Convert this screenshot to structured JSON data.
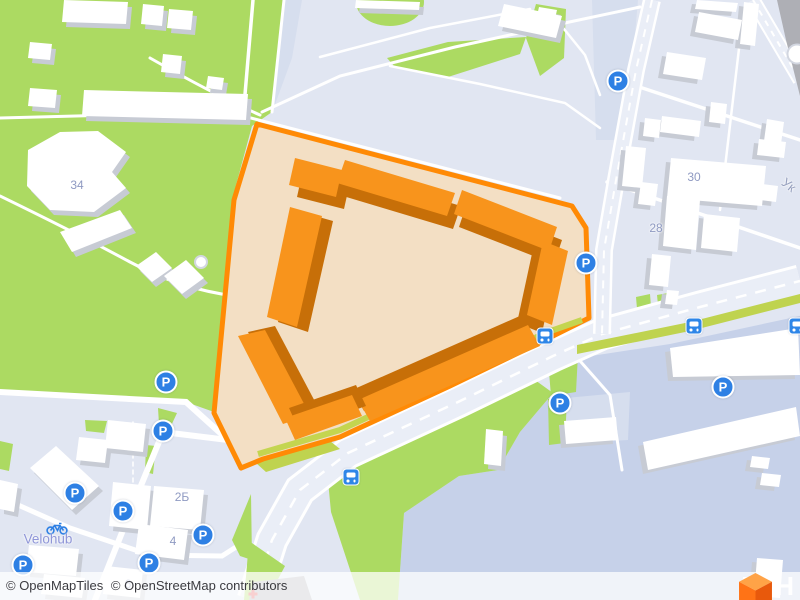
{
  "map": {
    "attribution": {
      "openmaptiles": "© OpenMapTiles",
      "osm": "© OpenStreetMap contributors"
    },
    "logo": {
      "text": "ЛУН"
    },
    "labels": {
      "buildings": [
        {
          "text": "34",
          "x": 77,
          "y": 185
        },
        {
          "text": "30",
          "x": 694,
          "y": 177
        },
        {
          "text": "28",
          "x": 656,
          "y": 228
        },
        {
          "text": "2Б",
          "x": 182,
          "y": 497
        },
        {
          "text": "4",
          "x": 173,
          "y": 541
        },
        {
          "text": "6",
          "x": 128,
          "y": 584
        }
      ],
      "streets": [
        {
          "text": "Ук",
          "x": 789,
          "y": 185,
          "rotation": 38
        }
      ],
      "pois": [
        {
          "text": "Velohub",
          "x": 48,
          "y": 539
        }
      ]
    },
    "icons": {
      "parking": {
        "glyph": "P",
        "color": "#2E80E4",
        "positions": [
          [
            163,
            431
          ],
          [
            75,
            493
          ],
          [
            123,
            511
          ],
          [
            203,
            535
          ],
          [
            23,
            565
          ],
          [
            149,
            563
          ],
          [
            166,
            382
          ],
          [
            618,
            81
          ],
          [
            586,
            263
          ],
          [
            723,
            387
          ],
          [
            560,
            403
          ]
        ]
      },
      "bus": {
        "color": "#2E86E8",
        "positions": [
          [
            545,
            336
          ],
          [
            694,
            326
          ],
          [
            351,
            477
          ],
          [
            797,
            326
          ]
        ]
      },
      "bicycle": {
        "color": "#2E80E4",
        "position": [
          46,
          521
        ]
      },
      "poi_circles": [
        {
          "x": 797,
          "y": 54,
          "d": 17
        },
        {
          "x": 201,
          "y": 262,
          "d": 10
        }
      ],
      "medical_cross": {
        "color": "#E54B4B",
        "position": [
          253,
          594
        ]
      }
    },
    "colors": {
      "land": "#E1E6F2",
      "water": "#C6D1E9",
      "park_green": "#ACDA62",
      "roadside_green": "#BFD34F",
      "road_fill": "#EAEEF7",
      "road_casing": "#FFFFFF",
      "plaza": "#D6DEEE",
      "building_fill": "#FFFFFF",
      "building_shadow": "#C7CBD4",
      "gray_strip": "#AEAFB5",
      "highlight_outline": "#FF8A05",
      "highlight_fill": "#F3DFC4",
      "highlight_building": "#F8941C",
      "highlight_building_shadow": "#C76F08",
      "marker_blue": "#2E80E4",
      "label_text": "#8F9AC2",
      "attribution_text": "#3B3B40",
      "medical": "#E54B4B",
      "logo_top": "#FFA347",
      "logo_left": "#FF7316",
      "logo_right": "#E8590C"
    }
  }
}
